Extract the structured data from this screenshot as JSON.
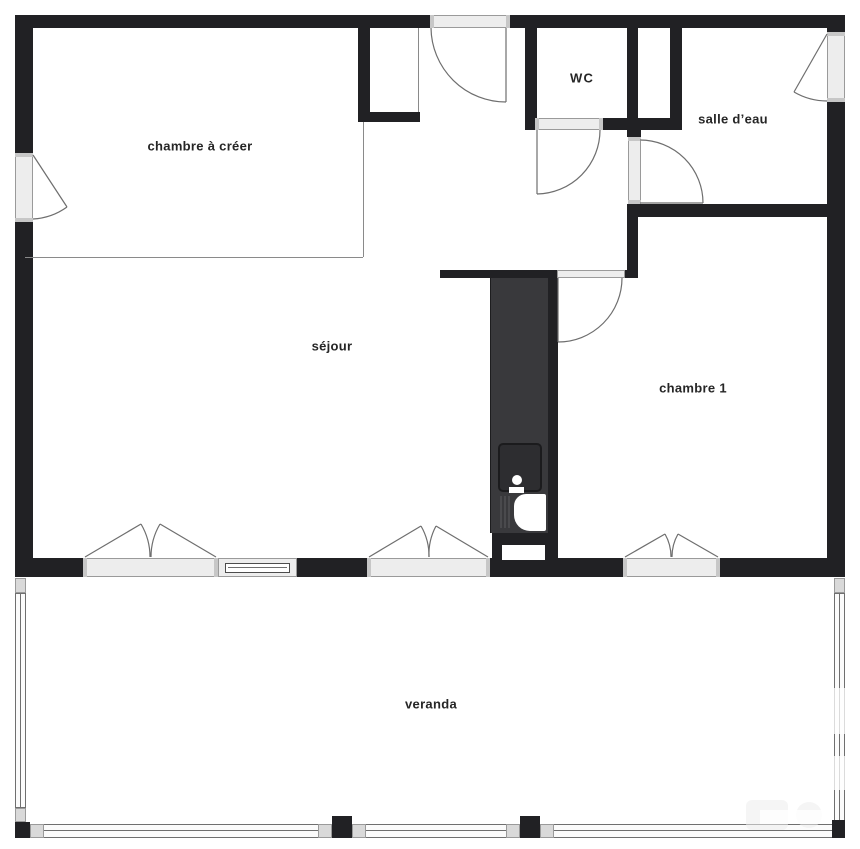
{
  "rooms": {
    "chambre_a_creer": "chambre à créer",
    "wc": "WC",
    "salle_deau": "salle d’eau",
    "sejour": "séjour",
    "chambre_1": "chambre 1",
    "veranda": "veranda"
  },
  "colors": {
    "wall": "#212124",
    "kitchen_block": "#39393c",
    "door_frame": "#ededed",
    "frame_border": "#9a9a9a",
    "swing_line": "#6e6e6e",
    "label_text": "#262626",
    "glazing_fill": "#fbfbfb"
  }
}
